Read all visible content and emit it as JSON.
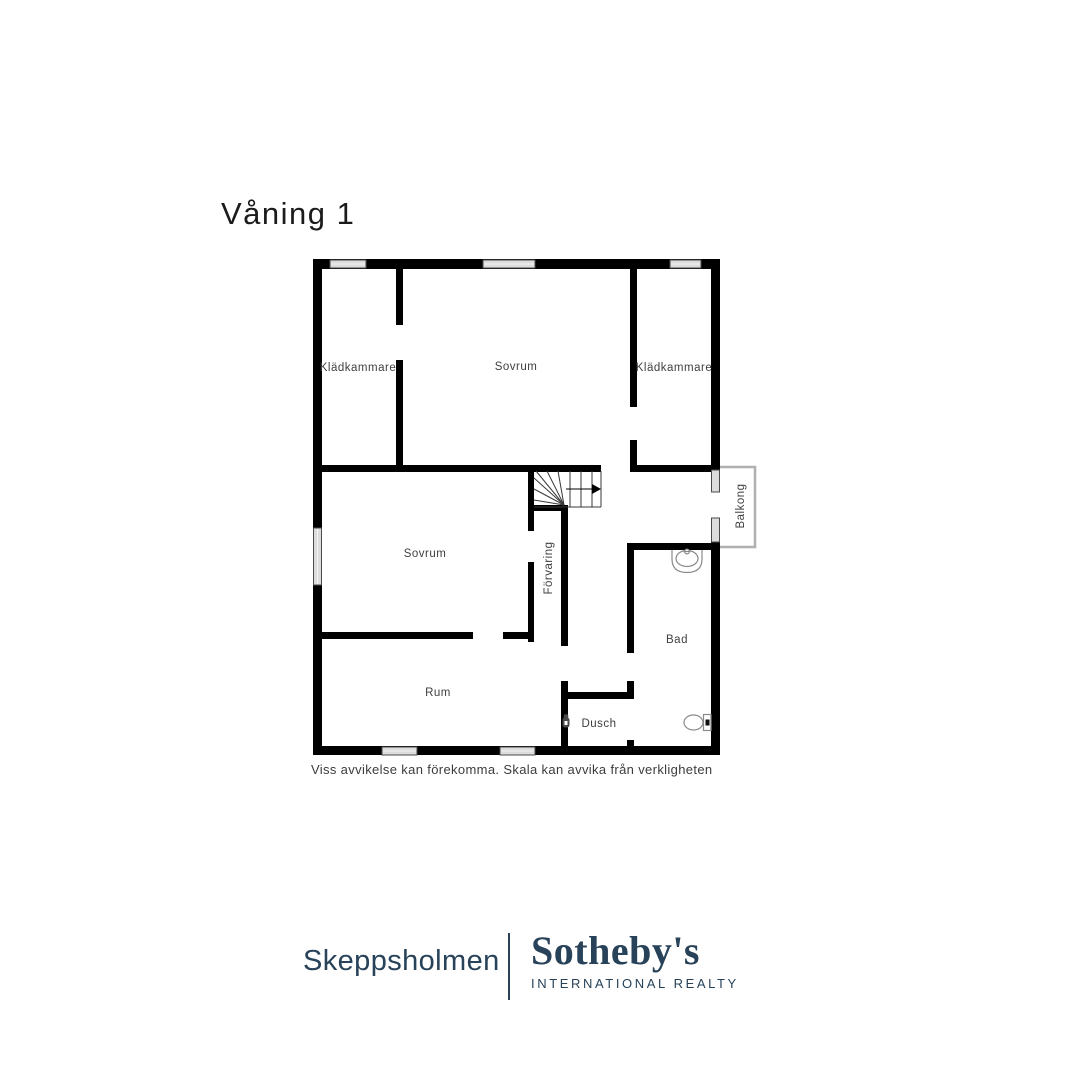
{
  "title": "Våning 1",
  "floorplan": {
    "rooms": [
      {
        "id": "kladkammare-left",
        "label": "Klädkammare"
      },
      {
        "id": "sovrum-upper",
        "label": "Sovrum"
      },
      {
        "id": "kladkammare-right",
        "label": "Klädkammare"
      },
      {
        "id": "sovrum-lower",
        "label": "Sovrum"
      },
      {
        "id": "forvaring",
        "label": "Förvaring"
      },
      {
        "id": "balkong",
        "label": "Balkong"
      },
      {
        "id": "bad",
        "label": "Bad"
      },
      {
        "id": "rum",
        "label": "Rum"
      },
      {
        "id": "dusch",
        "label": "Dusch"
      }
    ],
    "fixtures": [
      "stairs-with-direction-arrow",
      "sink",
      "toilet",
      "shower-mixer"
    ],
    "colors": {
      "walls": "#000000",
      "window_fill": "#dcdcdc",
      "window_stroke": "#4a4a4a",
      "balcony_outline": "#b0b0b0",
      "fixture_stroke": "#8a8a8a",
      "label_text": "#3f3f3f"
    }
  },
  "disclaimer": "Viss avvikelse kan förekomma. Skala kan avvika från verkligheten",
  "footer": {
    "agency": "Skeppsholmen",
    "brand": "Sotheby's",
    "brand_subtitle": "INTERNATIONAL REALTY",
    "brand_color": "#274259"
  }
}
